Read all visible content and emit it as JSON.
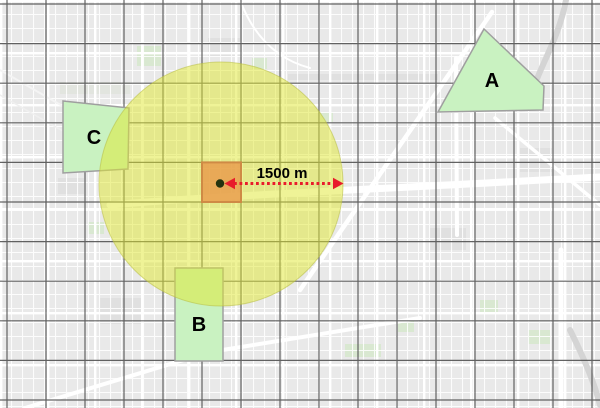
{
  "map": {
    "buffer": {
      "radius_label": "1500 m"
    },
    "zones": [
      {
        "label": "A"
      },
      {
        "label": "B"
      },
      {
        "label": "C"
      }
    ]
  },
  "colors": {
    "basemap_bg": "#e9e9e9",
    "street_white": "#ffffff",
    "grid_line": "#4d4d4d",
    "zone_fill": "#c9f2c1",
    "zone_stroke": "#9f9f9f",
    "buffer_fill": "#e0e82f",
    "buffer_stroke": "#c8ce53",
    "center_cell_fill": "#e8994a",
    "center_cell_stroke": "#cf8a45",
    "center_point_fill": "#25330e",
    "arrow_red": "#e81c2b",
    "label_text": "#000000"
  }
}
